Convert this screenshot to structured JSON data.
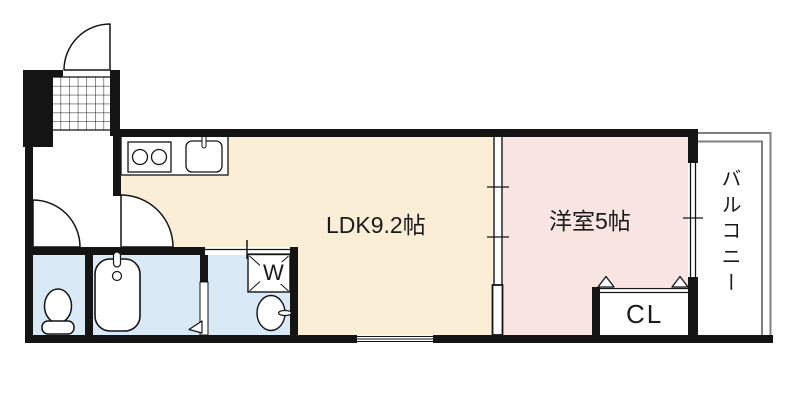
{
  "rooms": {
    "ldk_label": "LDK9.2帖",
    "bedroom_label": "洋室5帖",
    "balcony_label": "バルコニー",
    "closet_label": "CL",
    "washer_label": "W"
  },
  "colors": {
    "ldk_floor": "#faeed6",
    "bedroom_floor": "#f8e5e1",
    "wet_floor": "#d9e9f6",
    "wall": "#141414",
    "balcony_line": "#808080"
  }
}
